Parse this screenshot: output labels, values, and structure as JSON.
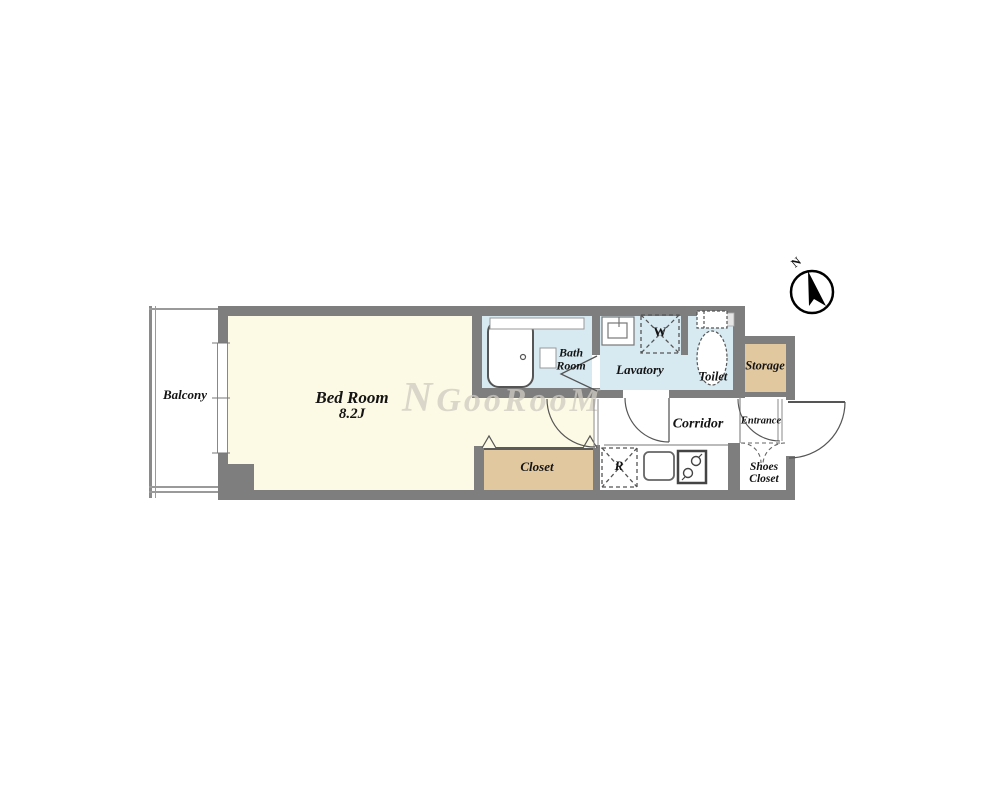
{
  "plan": {
    "rooms": {
      "balcony": {
        "label": "Balcony"
      },
      "bedroom": {
        "label": "Bed Room",
        "size": "8.2J"
      },
      "bathroom": {
        "line1": "Bath",
        "line2": "Room"
      },
      "lavatory": {
        "label": "Lavatory"
      },
      "toilet": {
        "label": "Toilet"
      },
      "storage": {
        "label": "Storage"
      },
      "corridor": {
        "label": "Corridor"
      },
      "entrance": {
        "label": "Entrance"
      },
      "shoes_closet": {
        "line1": "Shoes",
        "line2": "Closet"
      },
      "closet": {
        "label": "Closet"
      }
    },
    "fixtures": {
      "washing_machine": "W",
      "refrigerator": "R"
    },
    "compass": {
      "north": "N"
    },
    "watermark": {
      "initial": "N",
      "text": "GooRooM"
    },
    "colors": {
      "wall": "#7e7e7e",
      "room_cream": "#fcf9e4",
      "wet_area_blue": "#d7eaf2",
      "closet_tan": "#e1c89f",
      "background": "#ffffff",
      "text": "#141414"
    }
  }
}
